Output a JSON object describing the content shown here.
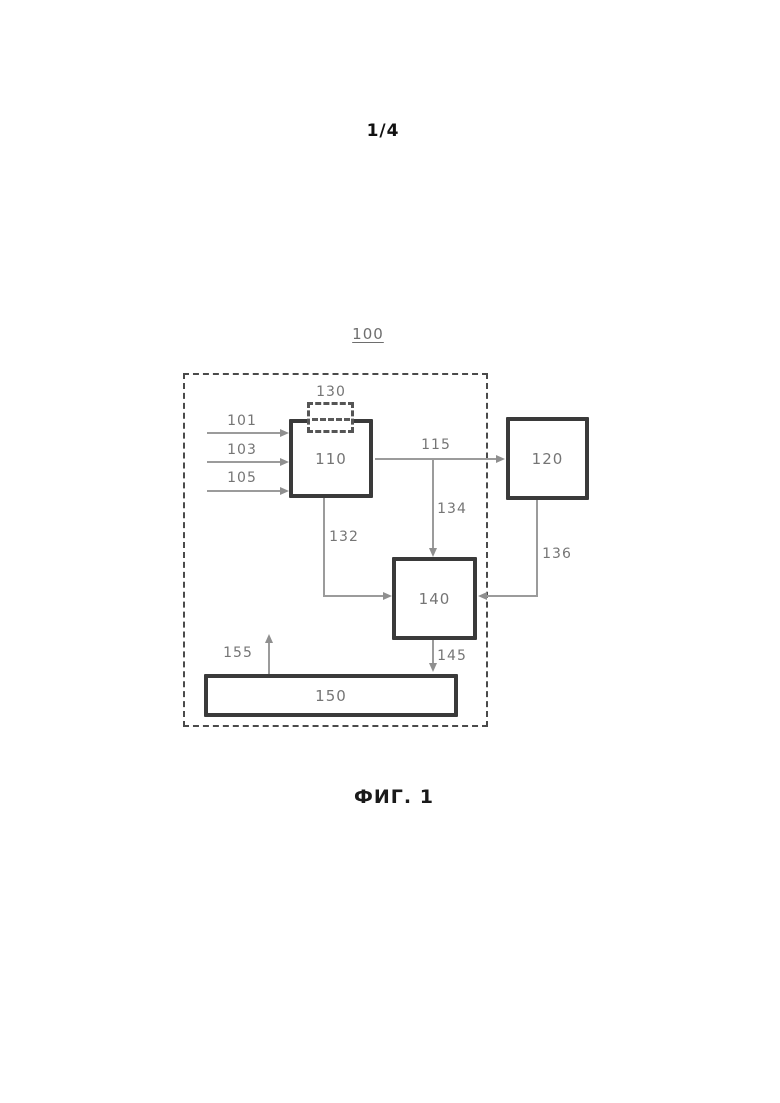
{
  "page": {
    "sheet_number": "1/4",
    "figure_caption": "ФИГ. 1"
  },
  "diagram": {
    "system_label": "100",
    "blocks": {
      "b110": {
        "label": "110"
      },
      "b120": {
        "label": "120"
      },
      "b130": {
        "label": "130"
      },
      "b140": {
        "label": "140"
      },
      "b150": {
        "label": "150"
      }
    },
    "signals": {
      "s101": {
        "label": "101"
      },
      "s103": {
        "label": "103"
      },
      "s105": {
        "label": "105"
      },
      "s115": {
        "label": "115"
      },
      "s132": {
        "label": "132"
      },
      "s134": {
        "label": "134"
      },
      "s136": {
        "label": "136"
      },
      "s145": {
        "label": "145"
      },
      "s155": {
        "label": "155"
      }
    },
    "colors": {
      "block_border": "#3a3a3a",
      "connector_line": "#9b9b9b",
      "number_label": "#757575",
      "dashed_boundary": "#4a4a4a",
      "caption_text": "#1a1a1a",
      "background": "#ffffff"
    }
  }
}
